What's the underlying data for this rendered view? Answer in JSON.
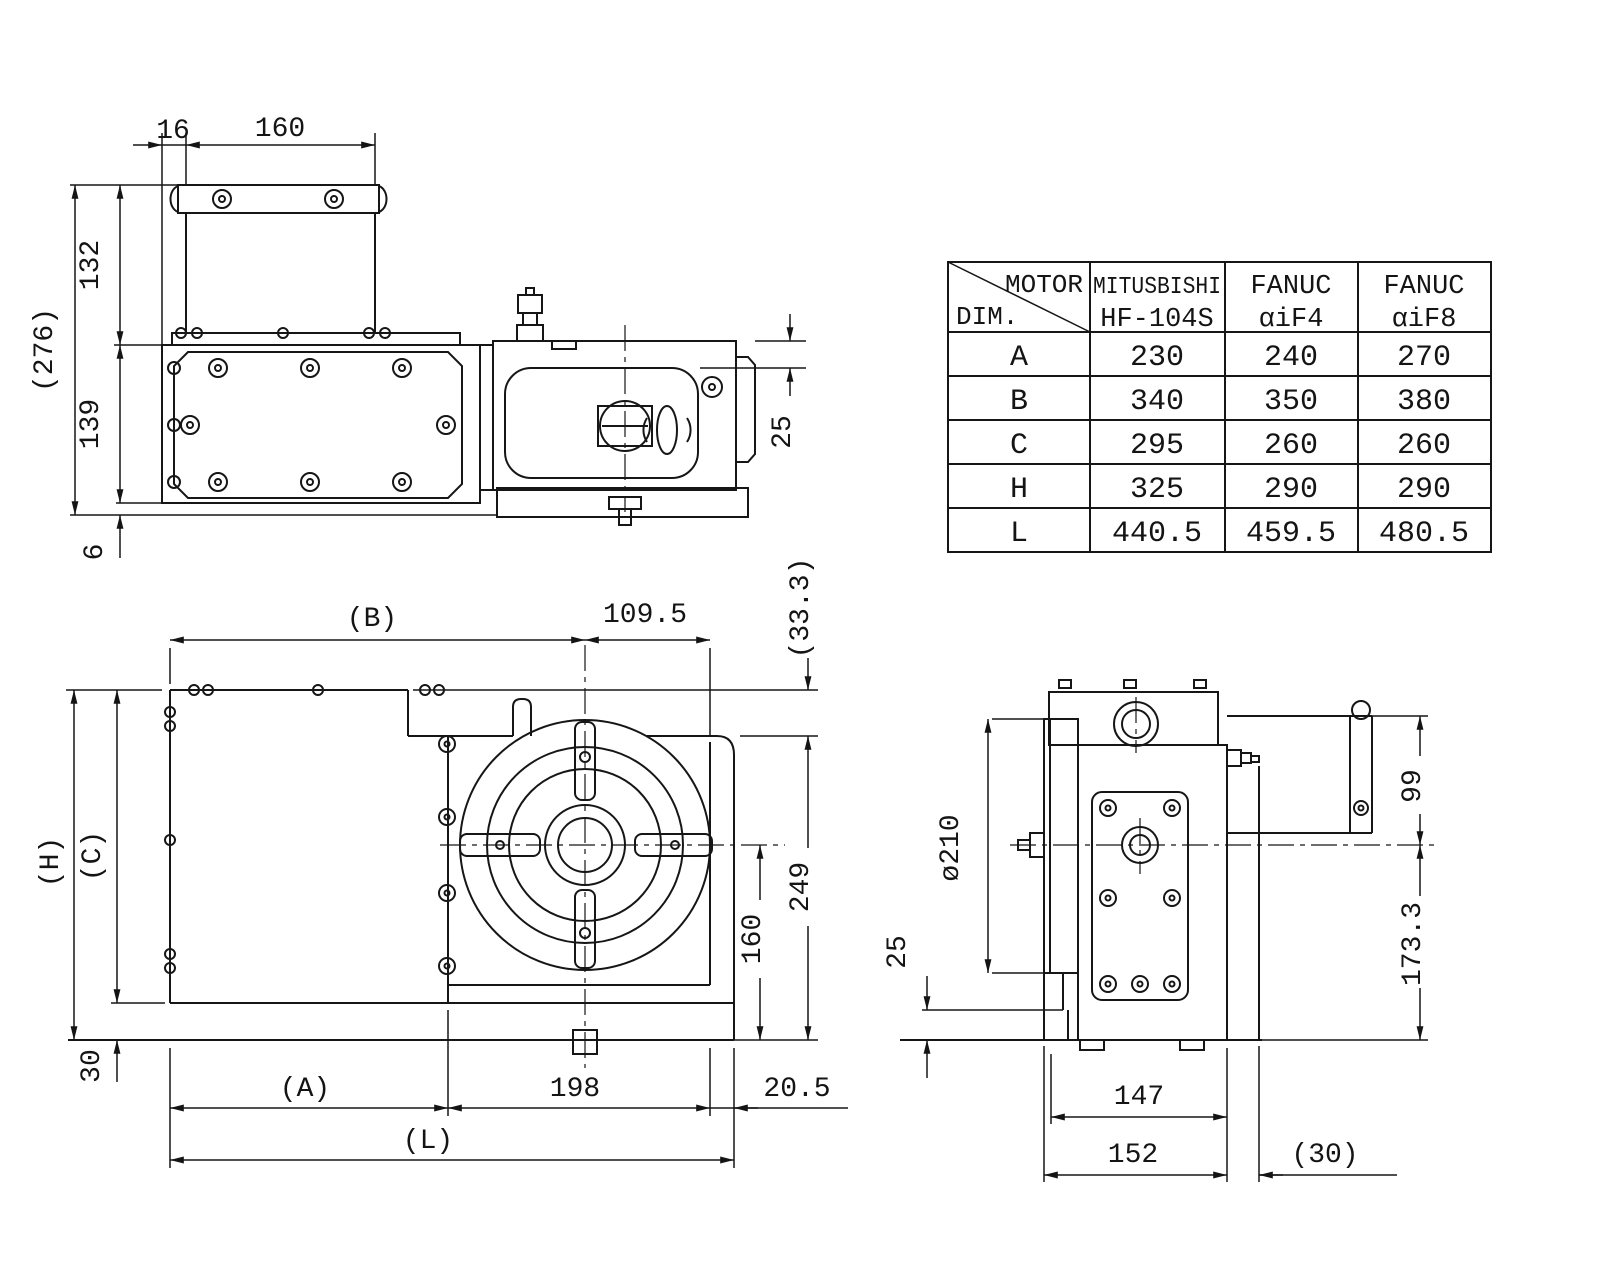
{
  "table": {
    "corner_top": "MOTOR",
    "corner_bottom": "DIM.",
    "col_headers": [
      {
        "line1": "MITUSBISHI",
        "line2": "HF-104S"
      },
      {
        "line1": "FANUC",
        "line2": "αiF4"
      },
      {
        "line1": "FANUC",
        "line2": "αiF8"
      }
    ],
    "rows": [
      {
        "dim": "A",
        "values": [
          "230",
          "240",
          "270"
        ]
      },
      {
        "dim": "B",
        "values": [
          "340",
          "350",
          "380"
        ]
      },
      {
        "dim": "C",
        "values": [
          "295",
          "260",
          "260"
        ]
      },
      {
        "dim": "H",
        "values": [
          "325",
          "290",
          "290"
        ]
      },
      {
        "dim": "L",
        "values": [
          "440.5",
          "459.5",
          "480.5"
        ]
      }
    ]
  },
  "top_view": {
    "w16": "16",
    "w160": "160",
    "h276": "(276)",
    "h132": "132",
    "h139": "139",
    "h6": "6",
    "d25": "25"
  },
  "front_view": {
    "b": "(B)",
    "w109": "109.5",
    "h33": "(33.3)",
    "h249": "249",
    "h160": "160",
    "hh": "(H)",
    "hc": "(C)",
    "h30": "30",
    "a": "(A)",
    "w198": "198",
    "w205": "20.5",
    "l": "(L)"
  },
  "side_view": {
    "dia": "ø210",
    "h25": "25",
    "h99": "99",
    "h173": "173.3",
    "w147": "147",
    "w152": "152",
    "w30": "(30)"
  }
}
